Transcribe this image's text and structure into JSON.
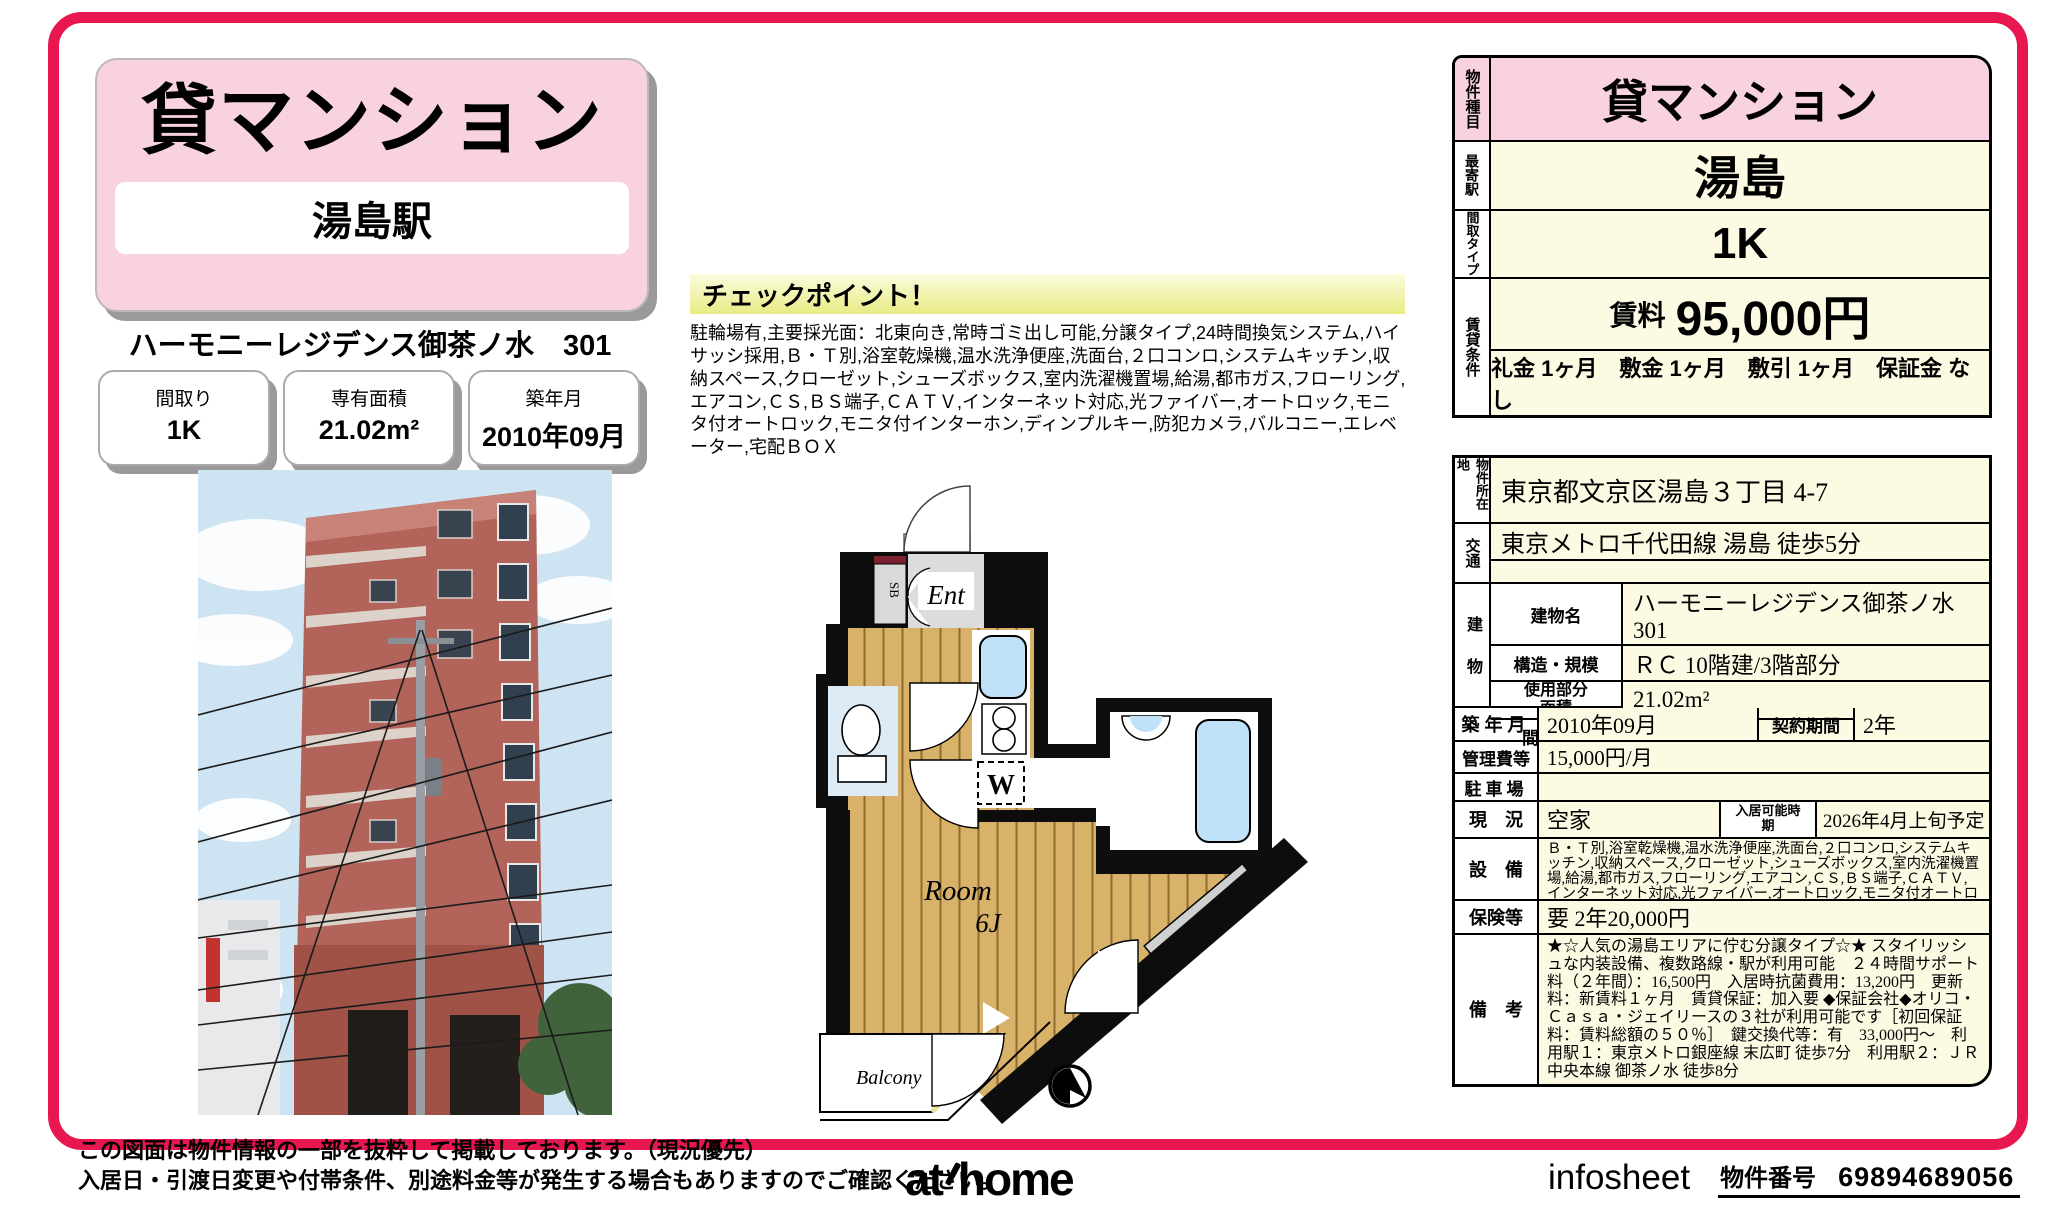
{
  "colors": {
    "frame_pink": "#E8174F",
    "light_pink": "#F8D2E0",
    "cream_yellow": "#FCFAE3",
    "checkpoint_yellow": "#E9EC84",
    "wood_floor": "#D9B26A",
    "fixture_blue": "#BFE2F8"
  },
  "header": {
    "category": "貸マンション",
    "station": "湯島駅",
    "building_line": "ハーモニーレジデンス御茶ノ水　301"
  },
  "spec_boxes": [
    {
      "label": "間取り",
      "value": "1K"
    },
    {
      "label": "専有面積",
      "value": "21.02m²"
    },
    {
      "label": "築年月",
      "value": "2010年09月"
    }
  ],
  "checkpoint": {
    "title": "チェックポイント！",
    "body": "駐輪場有,主要採光面：北東向き,常時ゴミ出し可能,分譲タイプ,24時間換気システム,ハイサッシ採用,Ｂ・Ｔ別,浴室乾燥機,温水洗浄便座,洗面台,２口コンロ,システムキッチン,収納スペース,クローゼット,シューズボックス,室内洗濯機置場,給湯,都市ガス,フローリング,エアコン,ＣＳ,ＢＳ端子,ＣＡＴＶ,インターネット対応,光ファイバー,オートロック,モニタ付オートロック,モニタ付インターホン,ディンプルキー,防犯カメラ,バルコニー,エレベーター,宅配ＢＯＸ"
  },
  "floorplan": {
    "ent": "Ent",
    "sb": "SB",
    "washer": "W",
    "closet": "Closet",
    "room_line1": "Room",
    "room_line2": "6J",
    "balcony": "Balcony"
  },
  "table_top": {
    "type_label": "物件種目",
    "type": "貸マンション",
    "station_label": "最寄駅",
    "station": "湯島",
    "layout_label": "間取タイプ",
    "layout": "1K",
    "terms_label": "賃貸条件",
    "rent_label": "賃料",
    "rent": "95,000円",
    "terms": "礼金 1ヶ月　敷金 1ヶ月　敷引 1ヶ月　保証金 なし"
  },
  "table_main": {
    "location_label": "物件所在地",
    "location": "東京都文京区湯島３丁目 4-7",
    "access_label": "交通",
    "access": "東京メトロ千代田線 湯島 徒歩5分",
    "building_label": "建物",
    "building_rows": [
      {
        "label": "建物名",
        "value": "ハーモニーレジデンス御茶ノ水　301"
      },
      {
        "label": "構造・規模",
        "value": "ＲＣ 10階建/3階部分"
      },
      {
        "label": "使用部分面積",
        "value": "21.02m²"
      },
      {
        "label": "間取内訳",
        "value": "洋６　Ｋ２"
      }
    ],
    "built_label": "築年月",
    "built": "2010年09月",
    "contract_label": "契約期間",
    "contract": "2年",
    "fee_label": "管理費等",
    "fee": "15,000円/月",
    "parking_label": "駐車場",
    "parking": "",
    "status_label": "現　況",
    "status": "空家",
    "movein_label": "入居可能時期",
    "movein": "2026年4月上旬予定",
    "equipment_label": "設　備",
    "equipment": "Ｂ・Ｔ別,浴室乾燥機,温水洗浄便座,洗面台,２口コンロ,システムキッチン,収納スペース,クローゼット,シューズボックス,室内洗濯機置場,給湯,都市ガス,フローリング,エアコン,ＣＳ,ＢＳ端子,ＣＡＴＶ,インターネット対応,光ファイバー,オートロック,モニタ付オートロック,モニタ付インタ...",
    "insurance_label": "保険等",
    "insurance": "要 2年20,000円",
    "notes_label": "備　考",
    "notes": "★☆人気の湯島エリアに佇む分譲タイプ☆★ スタイリッシュな内装設備、複数路線・駅が利用可能　２４時間サポート料（２年間）：16,500円　入居時抗菌費用：13,200円　更新料：新賃料１ヶ月　賃貸保証：加入要 ◆保証会社◆オリコ・Ｃａｓａ・ジェイリースの３社が利用可能です［初回保証料：賃料総額の５０％］　鍵交換代等：有　33,000円～　利用駅１：東京メトロ銀座線 末広町 徒歩7分　利用駅２：ＪＲ中央本線 御茶ノ水 徒歩8分"
  },
  "footer": {
    "disclaimer1": "この図面は物件情報の一部を抜粋して掲載しております。（現況優先）",
    "disclaimer2": "入居日・引渡日変更や付帯条件、別途料金等が発生する場合もありますのでご確認ください。",
    "logo_at": "at",
    "logo_home": "home",
    "infosheet": "infosheet",
    "property_no_label": "物件番号",
    "property_no": "69894689056"
  }
}
